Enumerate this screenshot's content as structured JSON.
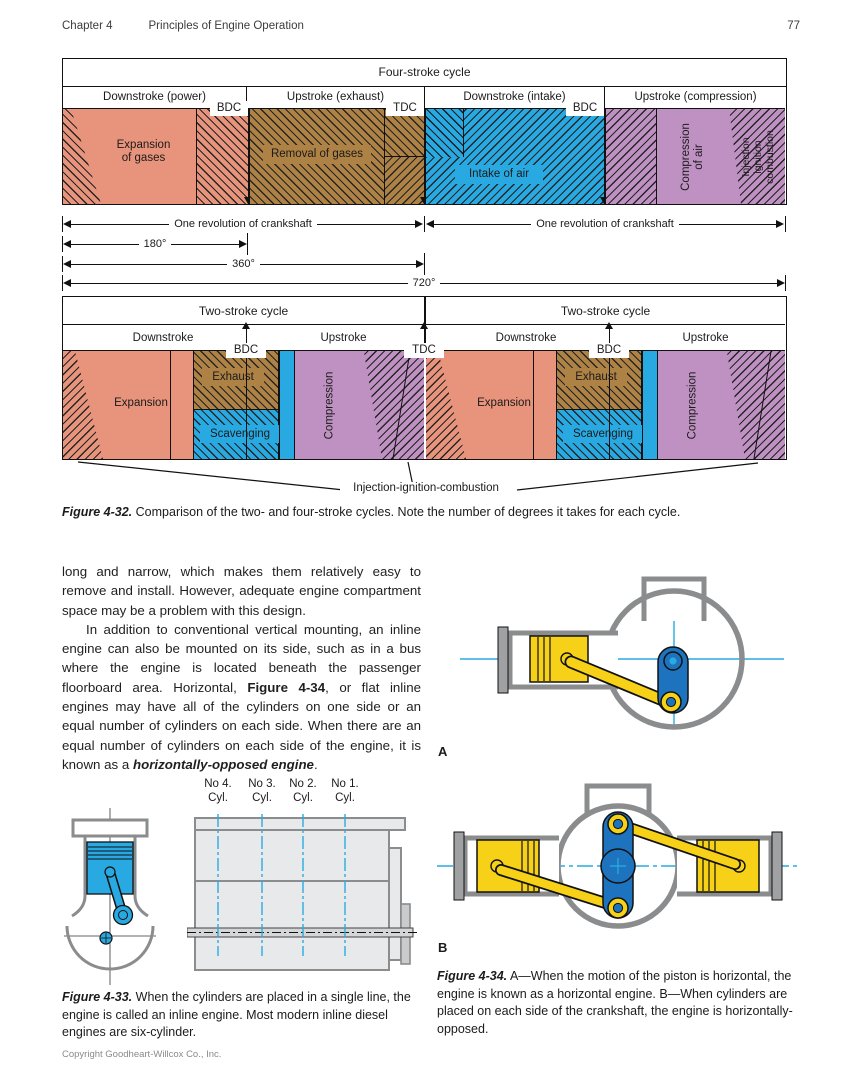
{
  "header": {
    "chapter": "Chapter 4",
    "title": "Principles of Engine Operation",
    "page_number": "77"
  },
  "fig32": {
    "four_stroke": {
      "title": "Four-stroke cycle",
      "col1": "Downstroke (power)",
      "col2": "Upstroke (exhaust)",
      "col3": "Downstroke (intake)",
      "col4": "Upstroke (compression)",
      "bdc": "BDC",
      "tdc": "TDC",
      "expansion": "Expansion\nof gases",
      "removal": "Removal of gases",
      "intake": "Intake of air",
      "compression": "Compression\nof air",
      "injection": "Injection\nignition\ncombustion"
    },
    "revolutions": {
      "one_rev": "One revolution of crankshaft",
      "deg180": "180°",
      "deg360": "360°",
      "deg720": "720°"
    },
    "two_stroke": {
      "title": "Two-stroke cycle",
      "downstroke": "Downstroke",
      "upstroke": "Upstroke",
      "bdc": "BDC",
      "tdc": "TDC",
      "expansion": "Expansion",
      "exhaust": "Exhaust",
      "scavenging": "Scavenging",
      "compression": "Compression"
    },
    "injection_callout": "Injection-ignition-combustion",
    "caption_label": "Figure 4-32.",
    "caption_text": " Comparison of the two- and four-stroke cycles. Note the number of degrees it takes for each cycle."
  },
  "body": {
    "p1": "long and narrow, which makes them relatively easy to remove and install. However, adequate engine compartment space may be a problem with this design.",
    "p2_1": "In addition to conventional vertical mounting, an inline engine can also be mounted on its side, such as in a bus where the engine is located beneath the passenger floorboard area. Horizontal, ",
    "p2_fig_ref": "Figure 4-34",
    "p2_2": ", or flat inline engines may have all of the cylinders on one side or an equal number of cylinders on each side. When there are an equal number of cylinders on each side of the engine, it is known as a ",
    "p2_term": "horizontally-opposed engine",
    "p2_3": "."
  },
  "fig33": {
    "cylinders": [
      {
        "no": "No 4.",
        "cyl": "Cyl."
      },
      {
        "no": "No 3.",
        "cyl": "Cyl."
      },
      {
        "no": "No 2.",
        "cyl": "Cyl."
      },
      {
        "no": "No 1.",
        "cyl": "Cyl."
      }
    ],
    "caption_label": "Figure 4-33.",
    "caption_text": " When the cylinders are placed in a single line, the engine is called an inline engine. Most modern inline diesel engines are six-cylinder."
  },
  "fig34": {
    "label_a": "A",
    "label_b": "B",
    "caption_label": "Figure 4-34.",
    "caption_text": " A—When the motion of the piston is horizontal, the engine is known as a horizontal engine. B—When cylinders are placed on each side of the crankshaft, the engine is horizontally-opposed."
  },
  "footer": {
    "copyright": "Copyright Goodheart-Willcox Co., Inc."
  },
  "colors": {
    "salmon": "#E8937B",
    "brown": "#AE8144",
    "blue": "#29A9E1",
    "purple": "#BF90C2",
    "yellow": "#F7D117",
    "crank_blue": "#1E73BE",
    "outline_gray": "#8A8C8D",
    "block_gray": "#E8E9EA",
    "centerline_cyan": "#29ABE2"
  }
}
